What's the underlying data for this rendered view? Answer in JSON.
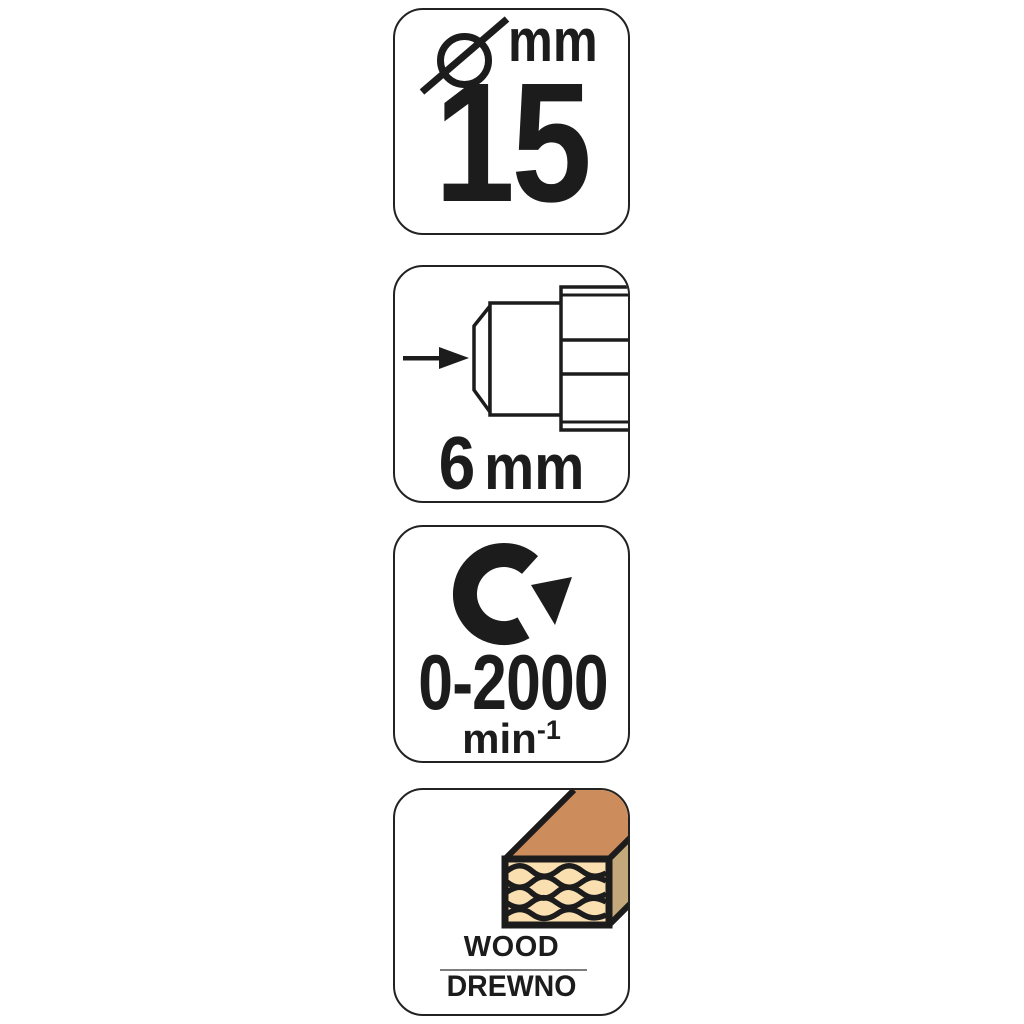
{
  "page": {
    "background": "#ffffff",
    "type": "product-spec-label-strip"
  },
  "colors": {
    "ink": "#1c1c1c",
    "card_border": "#222220",
    "wood_top": "#cd8c5b",
    "wood_side": "#c3a87c",
    "wood_face": "#fadfb0",
    "separator": "#7d7d7d"
  },
  "cards": [
    {
      "name": "diameter",
      "icon": "diameter-symbol-icon",
      "symbol": "Ø",
      "unit": "mm",
      "value": "15"
    },
    {
      "name": "shank-size",
      "icon": "drill-chuck-icon",
      "value": "6",
      "unit": "mm"
    },
    {
      "name": "rotation-speed",
      "icon": "clockwise-rotation-icon",
      "value": "0-2000",
      "unit": "min",
      "exponent": "-1"
    },
    {
      "name": "material",
      "icon": "wood-beam-icon",
      "label_primary": "WOOD",
      "label_secondary": "DREWNO"
    }
  ]
}
